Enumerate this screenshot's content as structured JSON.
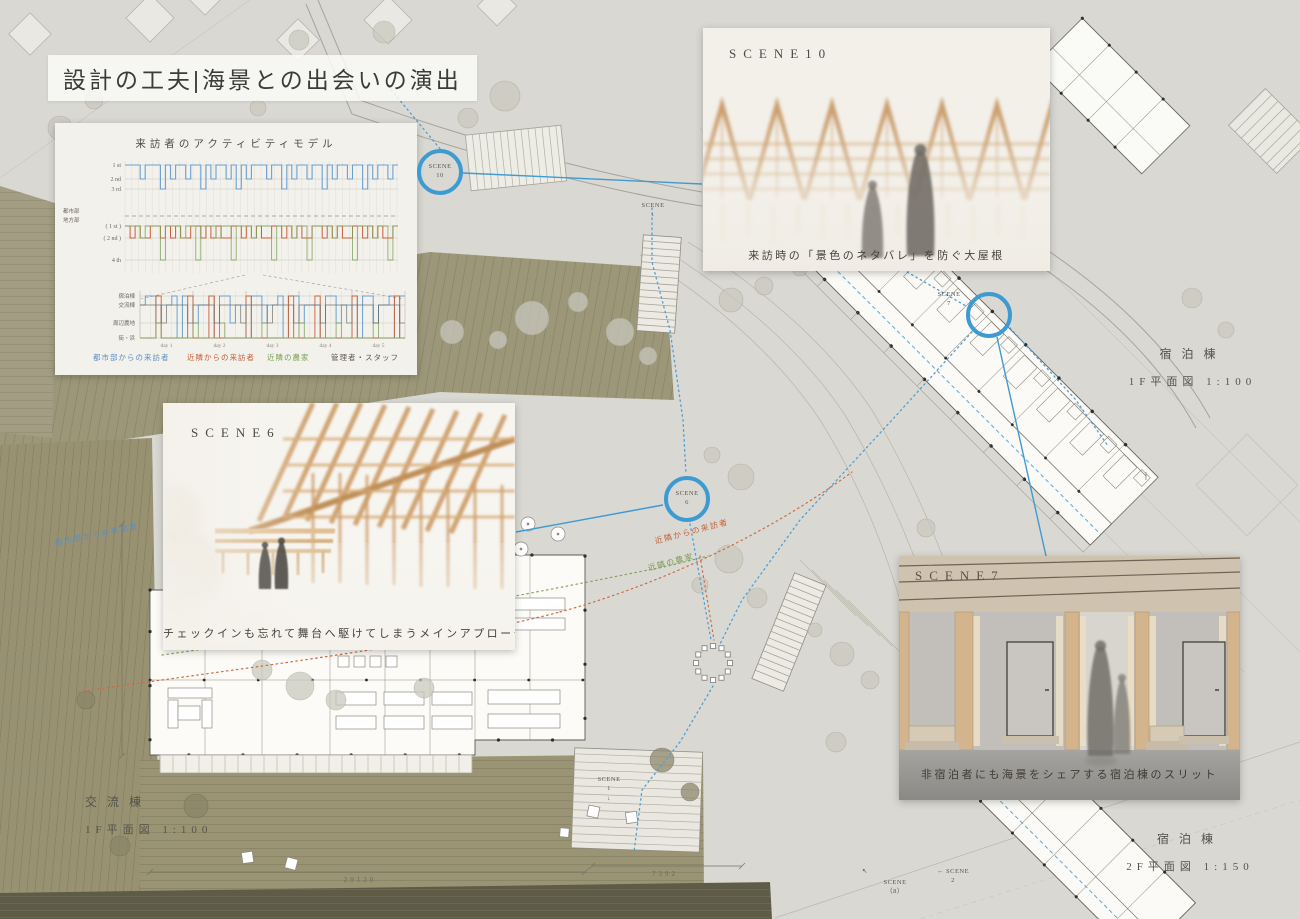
{
  "board": {
    "title": "設計の工夫|海景との出会いの演出"
  },
  "chart_data": {
    "type": "step-line",
    "title": "来訪者のアクティビティモデル",
    "upper": {
      "rows_a": [
        "1 st",
        "2 nd",
        "3 rd"
      ],
      "divider": [
        "都市部",
        "地方部"
      ],
      "rows_b": [
        "( 1 st )",
        "( 2 nd )",
        "4 th"
      ],
      "series": [
        {
          "name": "都市部からの来訪者",
          "color": "#69a0d2",
          "levels": "111211131211211312112131211121131211211312112113121121"
        },
        {
          "name": "近隣からの来訪者",
          "color": "#c9603a",
          "levels": "121221121212211212122112121221121212211212122112121221"
        },
        {
          "name": "近隣の農家",
          "color": "#7ba159",
          "levels": "111211131112113111211311121113111211311112111311121131"
        }
      ]
    },
    "lower": {
      "rows": [
        "宿泊棟",
        "交流棟",
        "周辺農地",
        "街・浜"
      ],
      "days": [
        "day 1",
        "day 2",
        "day 3",
        "day 4",
        "day 5"
      ],
      "series": [
        {
          "name": "都市部からの来訪者",
          "color": "#69a0d2",
          "levels": "21132214113221411322411322141132224113221411322141"
        },
        {
          "name": "近隣からの来訪者",
          "color": "#c9603a",
          "levels": "44414444414441444444144444441444414444441444444414"
        },
        {
          "name": "近隣の農家",
          "color": "#7ba159",
          "levels": "44434444443444434444444344444434444443444444344444"
        },
        {
          "name": "管理者・スタッフ",
          "color": "#67645c",
          "levels": "22223222232222322223222232222322223222232222322223"
        }
      ]
    },
    "legend": [
      {
        "label": "都市部からの来訪者",
        "color": "#69a0d2"
      },
      {
        "label": "近隣からの来訪者",
        "color": "#c9603a"
      },
      {
        "label": "近隣の農家",
        "color": "#7ba159"
      },
      {
        "label": "管理者・スタッフ",
        "color": "#5d5a52"
      }
    ]
  },
  "scenes": {
    "s10": {
      "label": "SCENE10",
      "caption": "来訪時の「景色のネタバレ」を防ぐ大屋根"
    },
    "s6": {
      "label": "SCENE6",
      "caption": "チェックインも忘れて舞台へ駆けてしまうメインアプローチ"
    },
    "s7": {
      "label": "SCENE7",
      "caption": "非宿泊者にも海景をシェアする宿泊棟のスリット"
    }
  },
  "markers": {
    "c10": {
      "t": "SCENE",
      "n": "10"
    },
    "c6": {
      "t": "SCENE",
      "n": "6"
    },
    "c7": {
      "t": "SCENE",
      "n": "7"
    },
    "m1": {
      "t": "SCENE",
      "n": "1"
    },
    "m2": {
      "t": "SCENE",
      "n": "2"
    },
    "m8": {
      "t": "SCENE",
      "n": "（8）"
    },
    "mtop": {
      "t": "SCENE",
      "n": ""
    }
  },
  "plan_labels": {
    "lodging1f": {
      "name": "宿泊棟",
      "scale": "1F平面図 1:100"
    },
    "lodging2f": {
      "name": "宿泊棟",
      "scale": "2F平面図 1:150"
    },
    "exchange1f": {
      "name": "交流棟",
      "scale": "1F平面図 1:100"
    }
  },
  "flow_labels": {
    "urban": "都市部からの来訪者",
    "neighbor": "近隣からの来訪者",
    "farmer": "近隣の農家"
  },
  "dimensions": {
    "d1": "29120",
    "d2": "7392"
  },
  "icons": {
    "down": "↓",
    "left": "←",
    "nw": "↖"
  }
}
